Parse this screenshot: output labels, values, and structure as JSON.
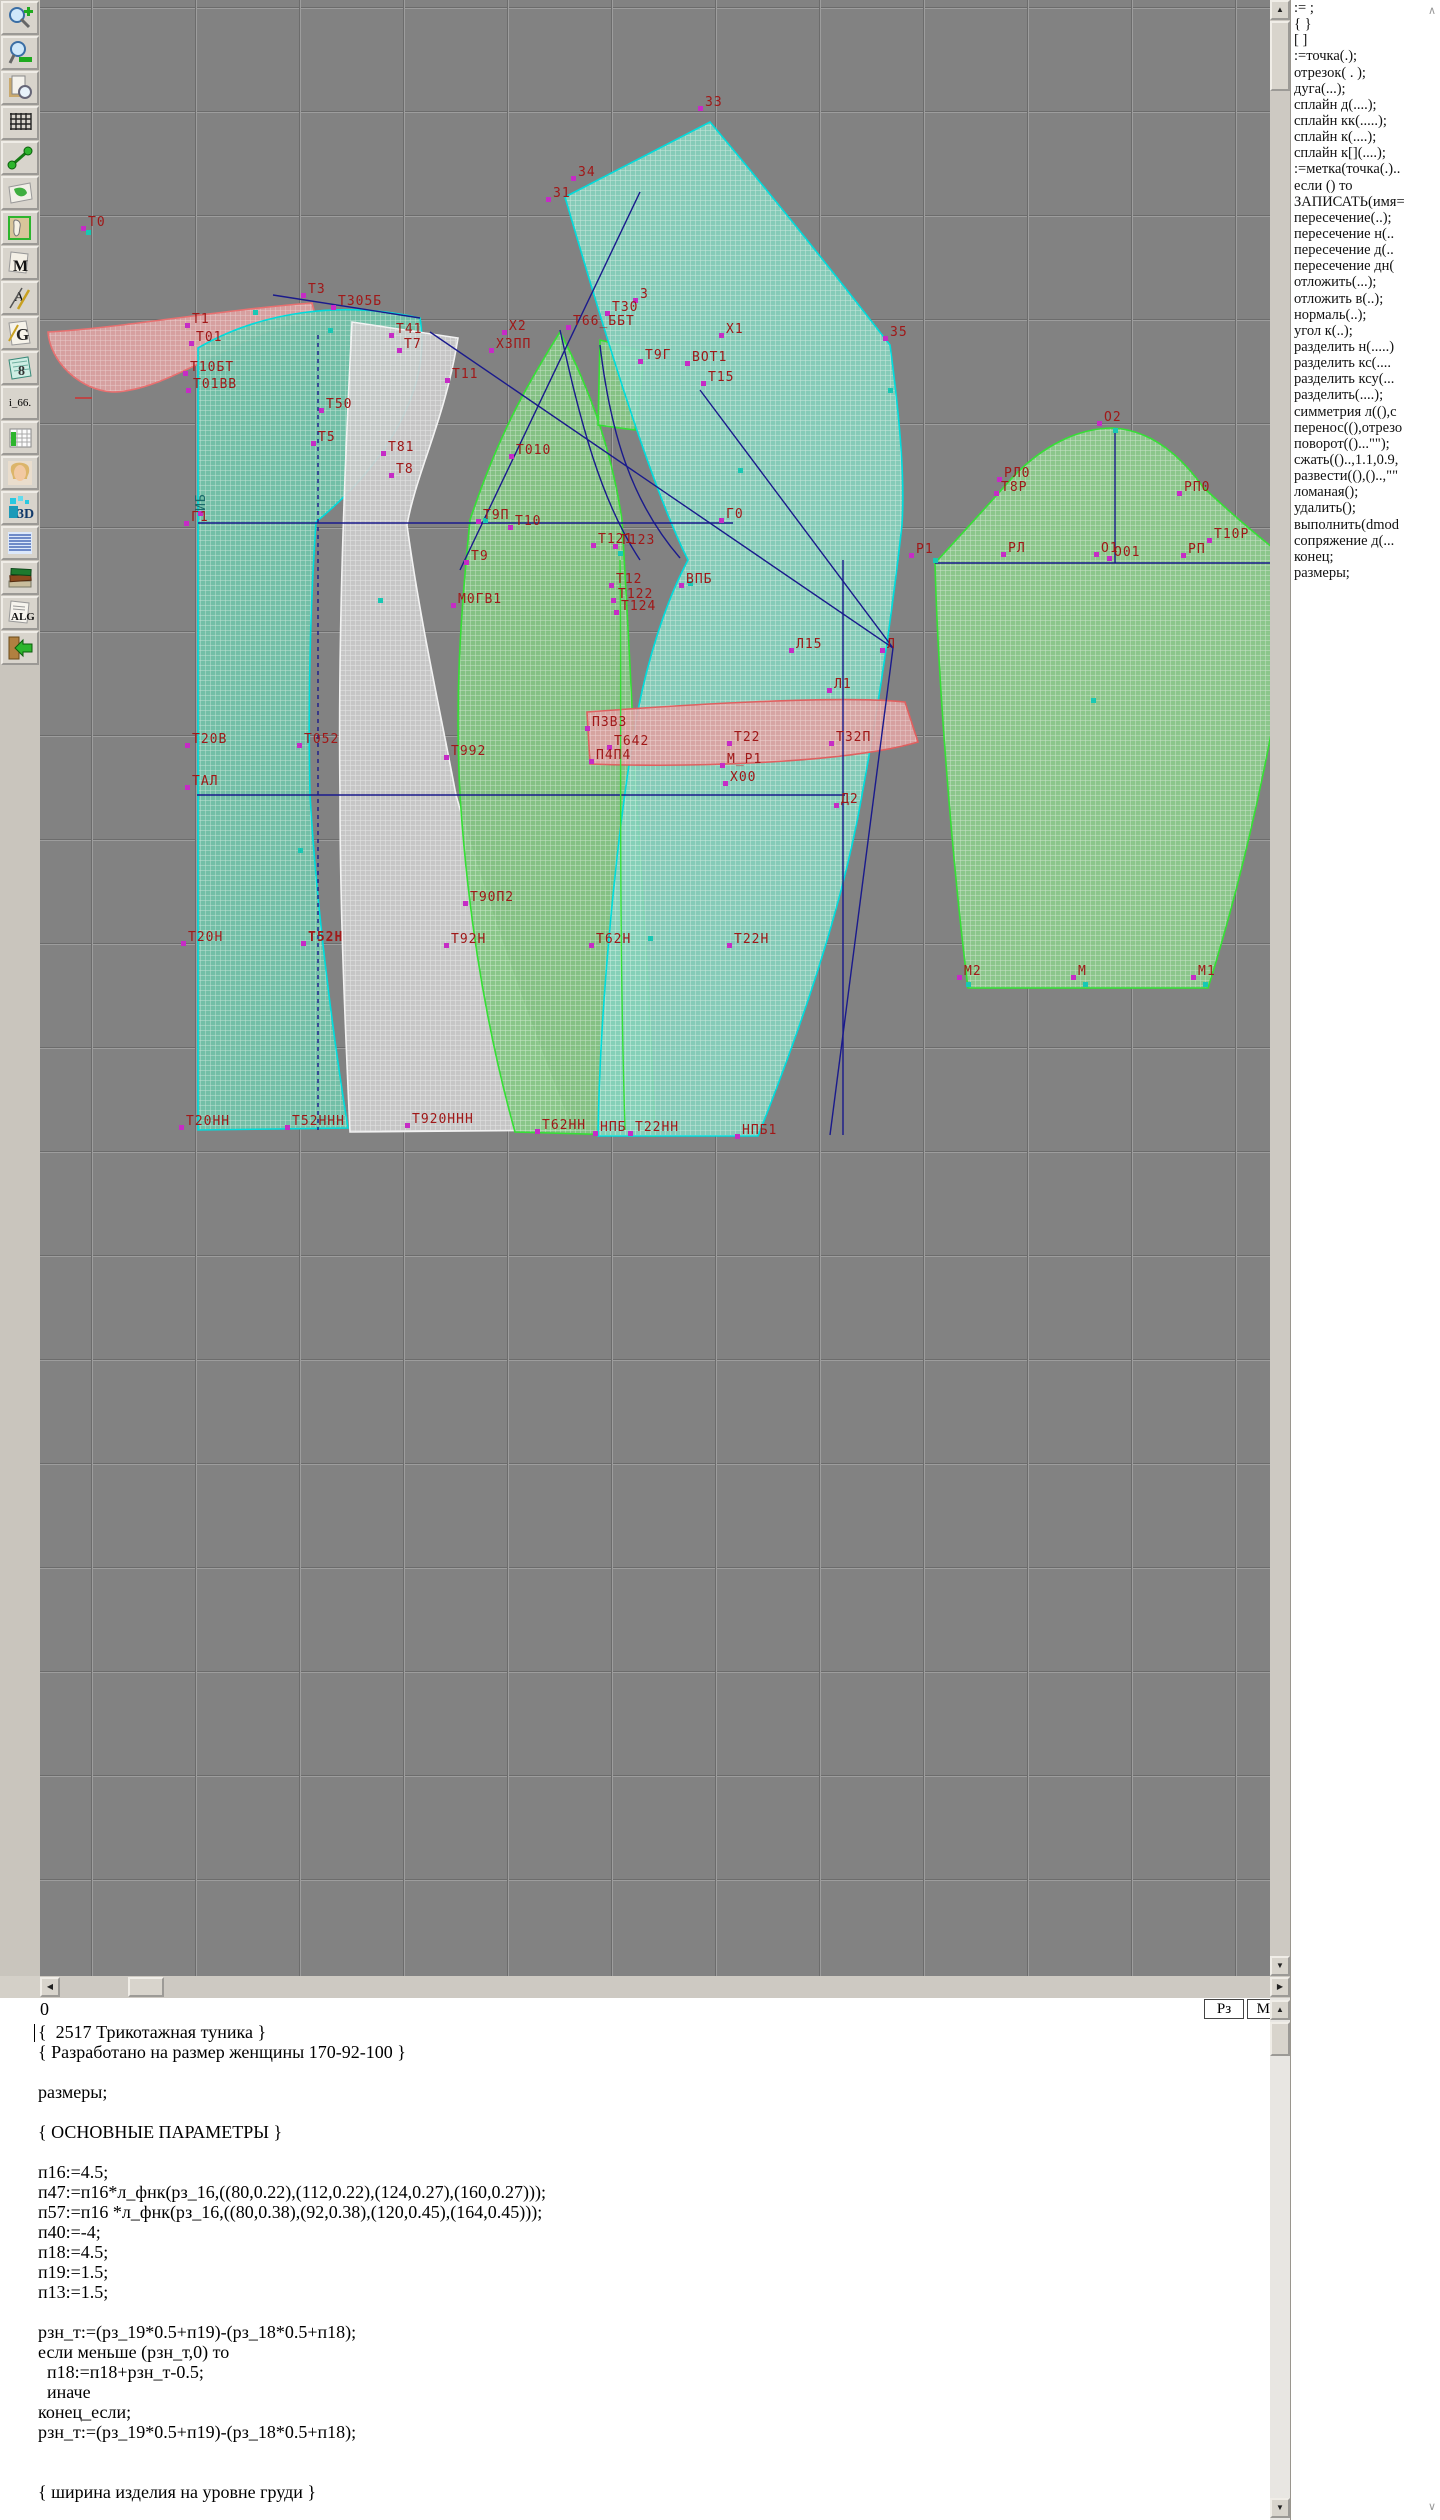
{
  "colors": {
    "label_red": "#a01818",
    "navy": "#1a1a8c",
    "cyan_edge": "#00dcdc",
    "green_edge": "#35e035",
    "white_edge": "#f2f2f2",
    "pink_edge": "#e06060",
    "canvas_bg": "#828282",
    "marker_magenta": "#c62bc6",
    "marker_teal": "#17c8b4"
  },
  "toolbar": {
    "items": [
      {
        "name": "zoom-in"
      },
      {
        "name": "zoom-out"
      },
      {
        "name": "print-preview"
      },
      {
        "name": "grid"
      },
      {
        "name": "measure"
      },
      {
        "name": "layout-map"
      },
      {
        "name": "pattern-sheet"
      },
      {
        "name": "marker-m",
        "label": "M"
      },
      {
        "name": "annotation",
        "label": "A"
      },
      {
        "name": "graphics",
        "label": "G"
      },
      {
        "name": "calculator",
        "label": "8"
      },
      {
        "name": "i66",
        "label": "i_66."
      },
      {
        "name": "table"
      },
      {
        "name": "photo"
      },
      {
        "name": "view3d",
        "label": "3D"
      },
      {
        "name": "text-list"
      },
      {
        "name": "books"
      },
      {
        "name": "algorithms",
        "label": "ALG"
      },
      {
        "name": "exit"
      }
    ]
  },
  "palette": {
    "lines": [
      ":= ;",
      "{  }",
      "[  ]",
      ":=точка(.);",
      "отрезок( . );",
      "дуга(...);",
      "сплайн  д(....);",
      "сплайн  кк(.....);",
      "сплайн  к(....);",
      "сплайн  к[](....);",
      ":=метка(точка(.)..",
      "если () то",
      "ЗАПИСАТЬ(имя=",
      "пересечение(..);",
      "пересечение  н(..",
      "пересечение  д(..",
      "пересечение  дн(",
      "отложить(...);",
      "отложить  в(..);",
      "нормаль(..);",
      "угол  к(..);",
      "разделить  н(.....)",
      "разделить  кс(....",
      "разделить  ксу(...",
      "разделить(....);",
      "симметрия  л((),с",
      "перенос((),отрезо",
      "поворот(()...\"\");",
      "сжать(()..,1.1,0.9,",
      "развести((),()..,\"\"",
      "ломаная();",
      "удалить();",
      "выполнить(dmod",
      "сопряжение  д(...",
      "конец;",
      "размеры;"
    ]
  },
  "statusbar": {
    "left": "0",
    "rz": "Рз",
    "ml": "Мл"
  },
  "editor": {
    "lines": [
      "{  2517 Трикотажная туника }",
      "{ Разработано на размер женщины 170-92-100 }",
      "",
      "размеры;",
      "",
      "{ ОСНОВНЫЕ ПАРАМЕТРЫ }",
      "",
      "п16:=4.5;",
      "п47:=п16*л_фнк(рз_16,((80,0.22),(112,0.22),(124,0.27),(160,0.27)));",
      "п57:=п16 *л_фнк(рз_16,((80,0.38),(92,0.38),(120,0.45),(164,0.45)));",
      "п40:=-4;",
      "п18:=4.5;",
      "п19:=1.5;",
      "п13:=1.5;",
      "",
      "рзн_т:=(рз_19*0.5+п19)-(рз_18*0.5+п18);",
      "если меньше (рзн_т,0) то",
      "  п18:=п18+рзн_т-0.5;",
      "  иначе",
      "конец_если;",
      "рзн_т:=(рз_19*0.5+п19)-(рз_18*0.5+п18);",
      "",
      "",
      "{ ширина изделия на уровне груди }"
    ]
  },
  "canvas": {
    "pieces": [
      {
        "name": "collar-band",
        "pat": "pink",
        "stroke": "#e87070",
        "d": "M8,332 C80,328 180,310 272,303 L276,318 C200,330 130,392 72,392 C40,390 10,362 8,332 Z"
      },
      {
        "name": "back-bodice",
        "pat": "teal",
        "stroke": "#00dcdc",
        "d": "M158,348 C220,312 300,300 380,318 C392,390 345,465 276,522 C270,610 268,700 270,795 C276,900 292,1030 308,1128 L158,1130 Z"
      },
      {
        "name": "side-back",
        "pat": "white",
        "stroke": "#f2f2f2",
        "d": "M312,322 L418,338 C405,420 377,470 367,525 C380,620 400,710 416,795 C448,910 496,1040 532,1130 L310,1132 C304,1000 300,900 300,795 C298,640 304,480 312,322 Z"
      },
      {
        "name": "front-side-panel",
        "pat": "green",
        "stroke": "#35e035",
        "d": "M520,332 C490,380 460,430 430,520 C420,620 415,700 420,795 C430,950 455,1060 475,1132 L615,1136 C610,1000 600,850 596,795 C590,650 584,560 582,520 C570,440 545,380 520,332 Z"
      },
      {
        "name": "front-strap",
        "pat": "green",
        "stroke": "#35e035",
        "d": "M560,340 L605,352 L595,430 L558,425 Z"
      },
      {
        "name": "front-bodice",
        "pat": "teal2",
        "stroke": "#00dcdc",
        "d": "M525,197 L670,122 C740,205 815,300 850,345 C860,420 865,480 862,525 C848,650 832,740 822,795 C802,910 760,1030 718,1136 L558,1136 C560,1000 578,820 598,710 C612,640 632,590 648,560 C608,480 558,310 525,197 Z"
      },
      {
        "name": "dart-wedge",
        "pat": "pink",
        "stroke": "#e06060",
        "d": "M547,712 C640,705 800,695 865,702 L878,742 C810,762 660,768 550,764 Z"
      },
      {
        "name": "sleeve",
        "pat": "green2",
        "stroke": "#35e035",
        "d": "M895,563 C918,538 948,505 972,478 C1002,446 1038,428 1073,428 C1108,430 1138,452 1163,487 C1198,520 1232,548 1253,563 C1248,680 1208,860 1168,988 L928,988 C912,860 898,680 895,563 Z"
      }
    ],
    "lines": [
      {
        "x1": 158,
        "y1": 523,
        "x2": 693,
        "y2": 523
      },
      {
        "x1": 157,
        "y1": 795,
        "x2": 805,
        "y2": 795
      },
      {
        "x1": 895,
        "y1": 563,
        "x2": 1255,
        "y2": 563
      },
      {
        "x1": 1075,
        "y1": 433,
        "x2": 1075,
        "y2": 563
      },
      {
        "x1": 803,
        "y1": 560,
        "x2": 803,
        "y2": 1135
      },
      {
        "x1": 278,
        "y1": 335,
        "x2": 278,
        "y2": 1130,
        "dash": "4 4"
      },
      {
        "x1": 390,
        "y1": 332,
        "x2": 853,
        "y2": 648
      },
      {
        "x1": 660,
        "y1": 390,
        "x2": 853,
        "y2": 648
      },
      {
        "x1": 853,
        "y1": 648,
        "x2": 790,
        "y2": 1135
      },
      {
        "x1": 600,
        "y1": 192,
        "x2": 420,
        "y2": 570
      },
      {
        "x1": 233,
        "y1": 295,
        "x2": 380,
        "y2": 318
      },
      {
        "d": "M520,330 C540,420 560,500 600,560"
      },
      {
        "d": "M560,345 C570,430 590,500 640,558"
      },
      {
        "d": "M580,560 C582,700 578,900 585,1130",
        "stroke": "#35e035"
      },
      {
        "x1": 35,
        "y1": 398,
        "x2": 52,
        "y2": 398,
        "stroke": "#cc3333"
      }
    ],
    "labels": [
      {
        "t": "Т0",
        "x": 88,
        "y": 215
      },
      {
        "t": "33",
        "x": 705,
        "y": 95
      },
      {
        "t": "34",
        "x": 578,
        "y": 165
      },
      {
        "t": "31",
        "x": 553,
        "y": 186
      },
      {
        "t": "35",
        "x": 890,
        "y": 325
      },
      {
        "t": "Т1",
        "x": 192,
        "y": 312
      },
      {
        "t": "Т01",
        "x": 196,
        "y": 330
      },
      {
        "t": "Т10БТ",
        "x": 190,
        "y": 360
      },
      {
        "t": "Т01ВВ",
        "x": 193,
        "y": 377
      },
      {
        "t": "Т3",
        "x": 308,
        "y": 282
      },
      {
        "t": "Т305Б",
        "x": 338,
        "y": 294
      },
      {
        "t": "Т41",
        "x": 396,
        "y": 322
      },
      {
        "t": "Т7",
        "x": 404,
        "y": 337
      },
      {
        "t": "Т50",
        "x": 326,
        "y": 397
      },
      {
        "t": "Т5",
        "x": 318,
        "y": 430
      },
      {
        "t": "Т81",
        "x": 388,
        "y": 440
      },
      {
        "t": "Т8",
        "x": 396,
        "y": 462
      },
      {
        "t": "Т11",
        "x": 452,
        "y": 367
      },
      {
        "t": "Х2",
        "x": 509,
        "y": 319
      },
      {
        "t": "Х3ПП",
        "x": 496,
        "y": 337
      },
      {
        "t": "3",
        "x": 640,
        "y": 287
      },
      {
        "t": "Т30",
        "x": 612,
        "y": 300
      },
      {
        "t": "Т66_ББТ",
        "x": 573,
        "y": 314
      },
      {
        "t": "Х1",
        "x": 726,
        "y": 322
      },
      {
        "t": "Т9Г",
        "x": 645,
        "y": 348
      },
      {
        "t": "ВОТ1",
        "x": 692,
        "y": 350
      },
      {
        "t": "Т15",
        "x": 708,
        "y": 370
      },
      {
        "t": "Г1",
        "x": 191,
        "y": 510
      },
      {
        "t": "ИБ",
        "x": 205,
        "y": 500,
        "rot": true,
        "c": "#1a6a6a"
      },
      {
        "t": "Т010",
        "x": 516,
        "y": 443
      },
      {
        "t": "Т9П",
        "x": 483,
        "y": 508
      },
      {
        "t": "Т10",
        "x": 515,
        "y": 514
      },
      {
        "t": "Г0",
        "x": 726,
        "y": 507
      },
      {
        "t": "Т121",
        "x": 598,
        "y": 532
      },
      {
        "t": "Т123",
        "x": 620,
        "y": 533
      },
      {
        "t": "Т9",
        "x": 471,
        "y": 549
      },
      {
        "t": "Т12",
        "x": 616,
        "y": 572
      },
      {
        "t": "ВПБ",
        "x": 686,
        "y": 572
      },
      {
        "t": "Т122",
        "x": 618,
        "y": 587
      },
      {
        "t": "Т124",
        "x": 621,
        "y": 599
      },
      {
        "t": "М0ГВ1",
        "x": 458,
        "y": 592
      },
      {
        "t": "Л15",
        "x": 796,
        "y": 637
      },
      {
        "t": "Л",
        "x": 887,
        "y": 637
      },
      {
        "t": "Л1",
        "x": 834,
        "y": 677
      },
      {
        "t": "П3В3",
        "x": 592,
        "y": 715
      },
      {
        "t": "Т642",
        "x": 614,
        "y": 734
      },
      {
        "t": "П4П4",
        "x": 596,
        "y": 748
      },
      {
        "t": "Т22",
        "x": 734,
        "y": 730
      },
      {
        "t": "Т32П",
        "x": 836,
        "y": 730
      },
      {
        "t": "М_Р1",
        "x": 727,
        "y": 752
      },
      {
        "t": "Х00",
        "x": 730,
        "y": 770
      },
      {
        "t": "Т20В",
        "x": 192,
        "y": 732
      },
      {
        "t": "Т052",
        "x": 304,
        "y": 732
      },
      {
        "t": "Т992",
        "x": 451,
        "y": 744
      },
      {
        "t": "ТАЛ",
        "x": 192,
        "y": 774
      },
      {
        "t": "Д2",
        "x": 841,
        "y": 792
      },
      {
        "t": "Т90П2",
        "x": 470,
        "y": 890
      },
      {
        "t": "Т20Н",
        "x": 188,
        "y": 930
      },
      {
        "t": "Т52Н",
        "x": 308,
        "y": 930,
        "bold": true
      },
      {
        "t": "Т92Н",
        "x": 451,
        "y": 932
      },
      {
        "t": "Т62Н",
        "x": 596,
        "y": 932
      },
      {
        "t": "Т22Н",
        "x": 734,
        "y": 932
      },
      {
        "t": "Т20НН",
        "x": 186,
        "y": 1114
      },
      {
        "t": "Т52ННН",
        "x": 292,
        "y": 1114
      },
      {
        "t": "Т920ННН",
        "x": 412,
        "y": 1112
      },
      {
        "t": "Т62НН",
        "x": 542,
        "y": 1118
      },
      {
        "t": "НПБ",
        "x": 600,
        "y": 1120
      },
      {
        "t": "Т22НН",
        "x": 635,
        "y": 1120
      },
      {
        "t": "НПБ1",
        "x": 742,
        "y": 1123
      },
      {
        "t": "О2",
        "x": 1104,
        "y": 410
      },
      {
        "t": "РЛ0",
        "x": 1004,
        "y": 466
      },
      {
        "t": "Т8Р",
        "x": 1001,
        "y": 480
      },
      {
        "t": "РП0",
        "x": 1184,
        "y": 480
      },
      {
        "t": "Т10Р",
        "x": 1214,
        "y": 527
      },
      {
        "t": "Р1",
        "x": 916,
        "y": 542
      },
      {
        "t": "РЛ",
        "x": 1008,
        "y": 541
      },
      {
        "t": "О1",
        "x": 1101,
        "y": 541
      },
      {
        "t": "О01",
        "x": 1114,
        "y": 545
      },
      {
        "t": "РП",
        "x": 1188,
        "y": 542
      },
      {
        "t": "М2",
        "x": 964,
        "y": 964
      },
      {
        "t": "М",
        "x": 1078,
        "y": 964
      },
      {
        "t": "М1",
        "x": 1198,
        "y": 964
      }
    ],
    "teal_dots": [
      [
        48,
        232
      ],
      [
        215,
        312
      ],
      [
        290,
        330
      ],
      [
        445,
        520
      ],
      [
        580,
        553
      ],
      [
        650,
        583
      ],
      [
        895,
        560
      ],
      [
        1075,
        430
      ],
      [
        1053,
        700
      ],
      [
        928,
        984
      ],
      [
        1045,
        984
      ],
      [
        1165,
        984
      ],
      [
        610,
        938
      ],
      [
        340,
        600
      ],
      [
        260,
        850
      ],
      [
        700,
        470
      ],
      [
        850,
        390
      ]
    ]
  }
}
